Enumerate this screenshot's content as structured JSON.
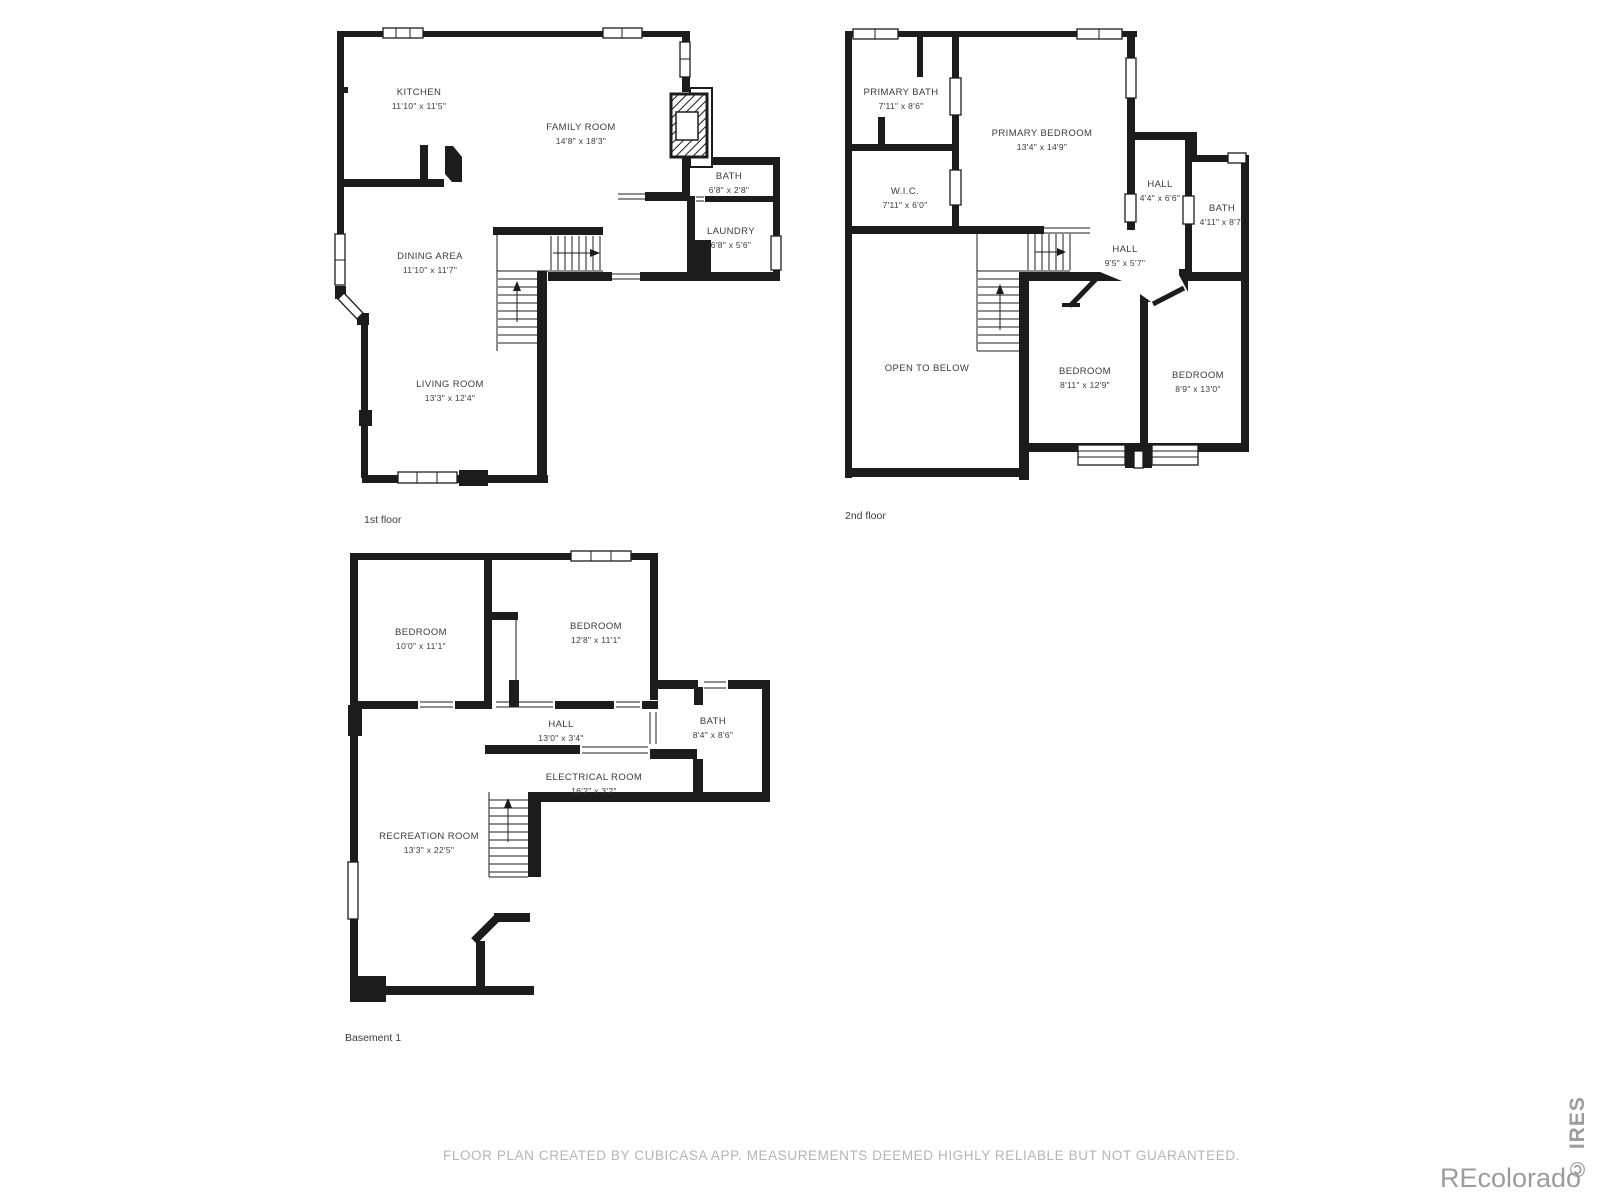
{
  "colors": {
    "wall": "#1c1c1c",
    "label": "#3b3b3b",
    "muted": "#b5b5b5",
    "watermark": "#9c9c9c"
  },
  "footer": {
    "disclaimer": "FLOOR PLAN CREATED BY CUBICASA APP. MEASUREMENTS DEEMED HIGHLY RELIABLE BUT NOT GUARANTEED."
  },
  "watermarks": {
    "recolorado": "REcolorado",
    "ires": "© IRES"
  },
  "floors": [
    {
      "id": "first-floor",
      "label": "1st floor",
      "label_pos": {
        "x": 364,
        "y": 514
      },
      "rooms": [
        {
          "id": "kitchen",
          "name": "KITCHEN",
          "dims": "11'10\" x 11'5\"",
          "x": 419,
          "y": 86
        },
        {
          "id": "family-room",
          "name": "FAMILY ROOM",
          "dims": "14'8\" x 18'3\"",
          "x": 581,
          "y": 121
        },
        {
          "id": "bath-1",
          "name": "BATH",
          "dims": "6'8\" x 2'8\"",
          "x": 729,
          "y": 170
        },
        {
          "id": "laundry",
          "name": "LAUNDRY",
          "dims": "6'8\" x 5'6\"",
          "x": 731,
          "y": 225
        },
        {
          "id": "dining-area",
          "name": "DINING AREA",
          "dims": "11'10\" x 11'7\"",
          "x": 430,
          "y": 250
        },
        {
          "id": "living-room",
          "name": "LIVING ROOM",
          "dims": "13'3\" x 12'4\"",
          "x": 450,
          "y": 378
        }
      ]
    },
    {
      "id": "second-floor",
      "label": "2nd floor",
      "label_pos": {
        "x": 845,
        "y": 510
      },
      "rooms": [
        {
          "id": "primary-bath",
          "name": "PRIMARY BATH",
          "dims": "7'11\" x 8'6\"",
          "x": 901,
          "y": 86
        },
        {
          "id": "primary-bedroom",
          "name": "PRIMARY BEDROOM",
          "dims": "13'4\" x 14'9\"",
          "x": 1042,
          "y": 127
        },
        {
          "id": "wic",
          "name": "W.I.C.",
          "dims": "7'11\" x 6'0\"",
          "x": 905,
          "y": 185
        },
        {
          "id": "hall-upper",
          "name": "HALL",
          "dims": "4'4\" x 6'6\"",
          "x": 1160,
          "y": 178
        },
        {
          "id": "bath-upper",
          "name": "BATH",
          "dims": "4'11\" x 8'7\"",
          "x": 1222,
          "y": 202
        },
        {
          "id": "hall-landing",
          "name": "HALL",
          "dims": "9'5\" x 5'7\"",
          "x": 1125,
          "y": 243
        },
        {
          "id": "open-to-below",
          "name": "OPEN TO BELOW",
          "dims": "",
          "x": 927,
          "y": 362
        },
        {
          "id": "bedroom-2",
          "name": "BEDROOM",
          "dims": "8'11\" x 12'9\"",
          "x": 1085,
          "y": 365
        },
        {
          "id": "bedroom-3",
          "name": "BEDROOM",
          "dims": "8'9\" x 13'0\"",
          "x": 1198,
          "y": 369
        }
      ]
    },
    {
      "id": "basement",
      "label": "Basement 1",
      "label_pos": {
        "x": 345,
        "y": 1032
      },
      "rooms": [
        {
          "id": "bedroom-4",
          "name": "BEDROOM",
          "dims": "10'0\" x 11'1\"",
          "x": 421,
          "y": 626
        },
        {
          "id": "bedroom-5",
          "name": "BEDROOM",
          "dims": "12'8\" x 11'1\"",
          "x": 596,
          "y": 620
        },
        {
          "id": "hall-basement",
          "name": "HALL",
          "dims": "13'0\" x 3'4\"",
          "x": 561,
          "y": 718
        },
        {
          "id": "bath-basement",
          "name": "BATH",
          "dims": "8'4\" x 8'6\"",
          "x": 713,
          "y": 715
        },
        {
          "id": "electrical-room",
          "name": "ELECTRICAL ROOM",
          "dims": "16'2\" x 3'2\"",
          "x": 594,
          "y": 771
        },
        {
          "id": "recreation-room",
          "name": "RECREATION ROOM",
          "dims": "13'3\" x 22'5\"",
          "x": 429,
          "y": 830
        }
      ]
    }
  ]
}
